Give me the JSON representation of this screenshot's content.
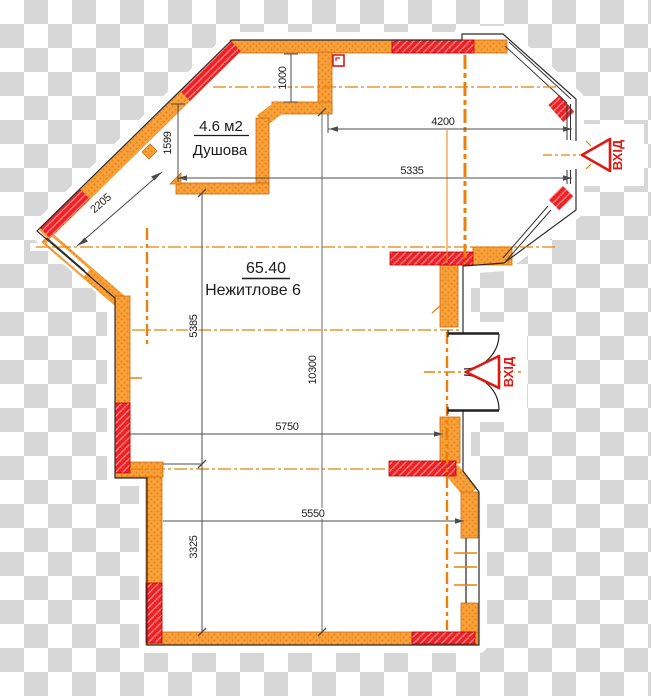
{
  "drawing": {
    "type": "floor-plan",
    "rooms": {
      "shower": {
        "area": "4.6 м2",
        "name": "Душова"
      },
      "main": {
        "area": "65.40",
        "name": "Нежитлове 6"
      }
    },
    "entrances": [
      {
        "label": "ВХІД",
        "location": "right-bay"
      },
      {
        "label": "ВХІД",
        "location": "right-middle"
      }
    ],
    "dimensions": {
      "top_offset": "1000",
      "shower_height": "1599",
      "diagonal_wall": "2205",
      "bay_width_upper": "4200",
      "bay_width_lower": "5335",
      "left_upper_height": "5385",
      "total_height": "10300",
      "middle_width": "5750",
      "lower_width": "5550",
      "left_lower_height": "3325"
    },
    "colors": {
      "wall_orange": "#f8a03c",
      "wall_orange_dot": "#e8830e",
      "wall_outline": "#d2690e",
      "window_red": "#ec2227",
      "red_hatch_light": "#ff8a8a",
      "axis_orange": "#e8820c",
      "dimension_line": "#4d4d4d",
      "entrance_red": "#e01812",
      "outline_black": "#2b2b2b",
      "checker_gray": "#d7d7d7"
    }
  }
}
